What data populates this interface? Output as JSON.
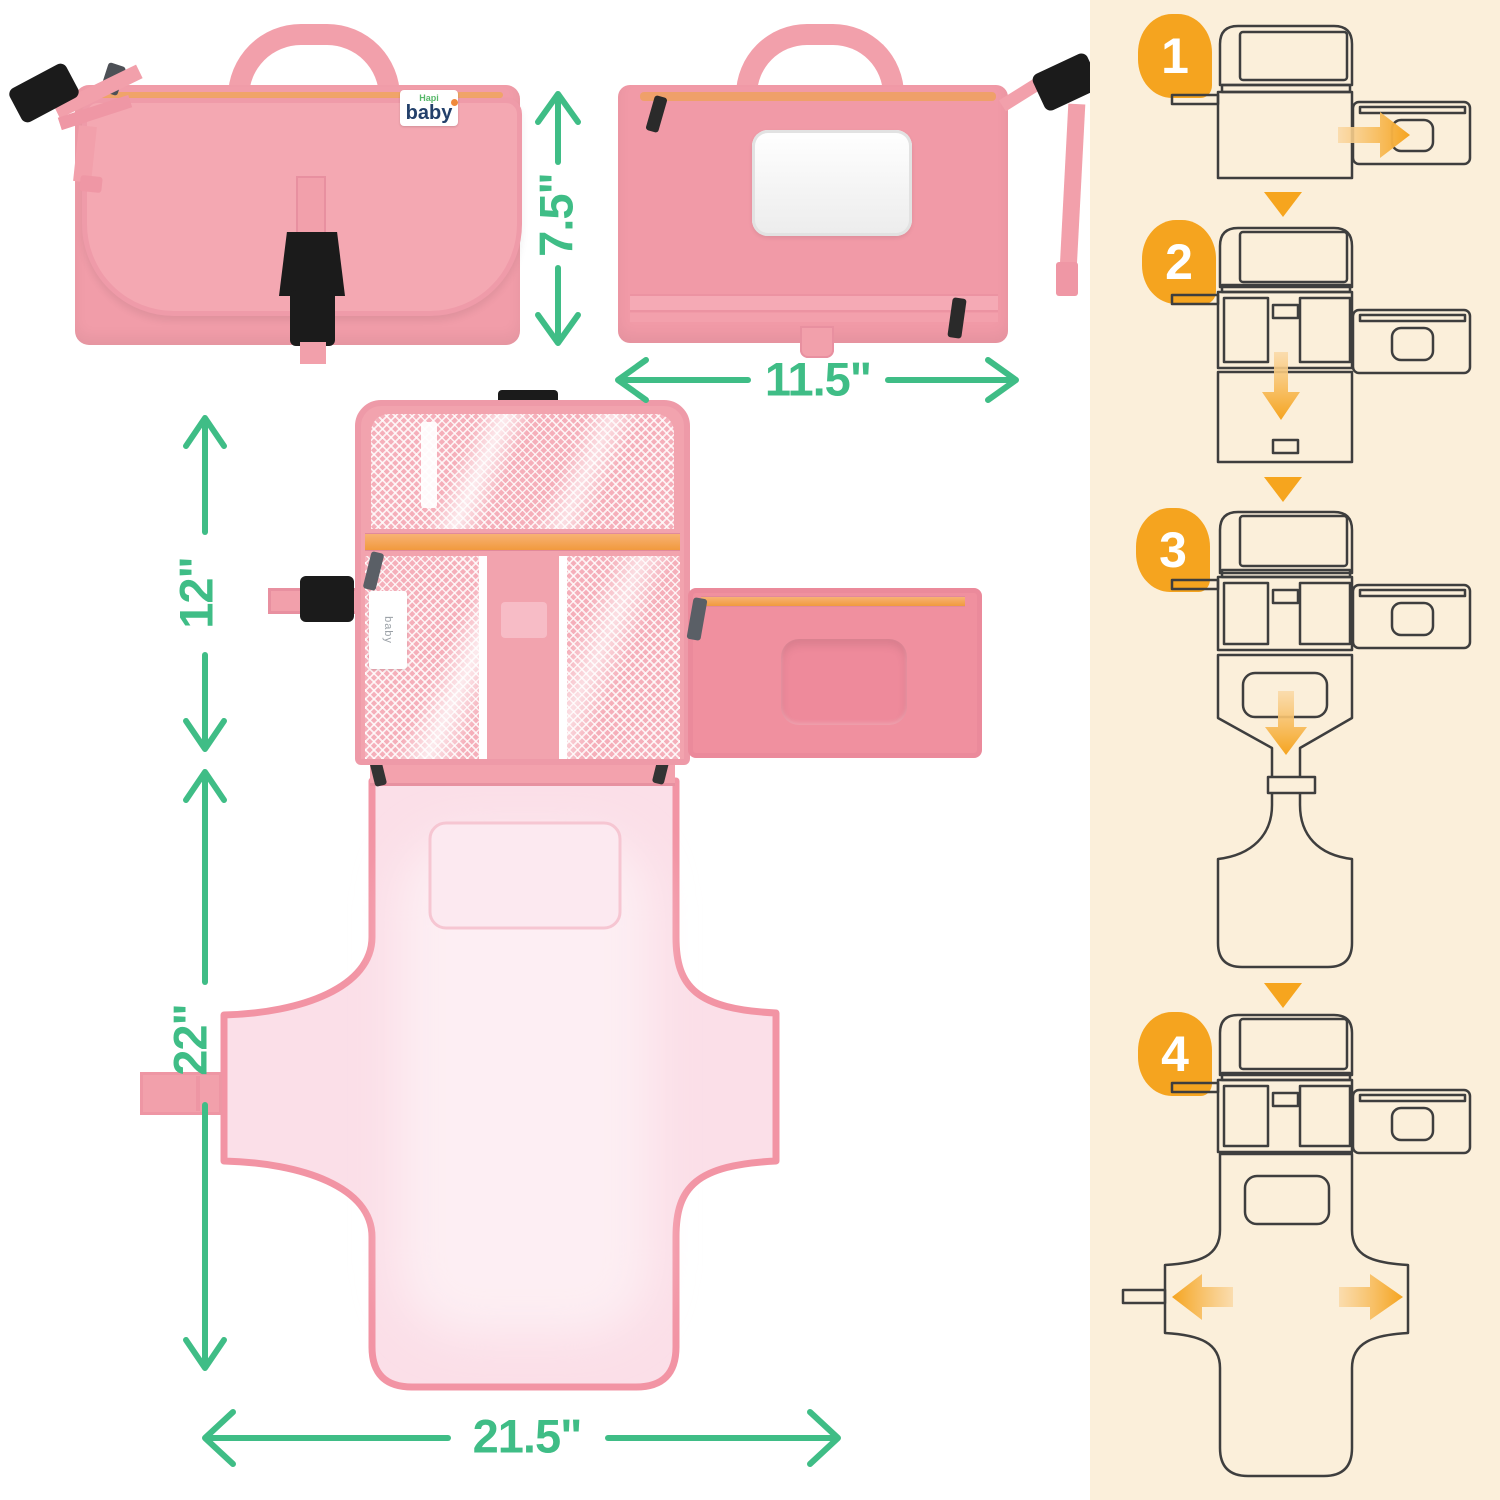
{
  "front_label": {
    "line1": "Hapi",
    "line2": "baby"
  },
  "care_label": {
    "text": "baby"
  },
  "dimensions": {
    "folded_height": "7.5\"",
    "folded_width": "11.5\"",
    "organizer_height": "12\"",
    "mat_length": "22\"",
    "mat_width": "21.5\""
  },
  "steps": [
    {
      "number": "1"
    },
    {
      "number": "2"
    },
    {
      "number": "3"
    },
    {
      "number": "4"
    }
  ],
  "colors": {
    "dimension_green": "#3FBD86",
    "step_orange": "#F5A41F",
    "pad_pink": "#F19DA9",
    "mat_pale_pink": "#FBDFE8",
    "panel_cream": "#FBEFDA"
  }
}
